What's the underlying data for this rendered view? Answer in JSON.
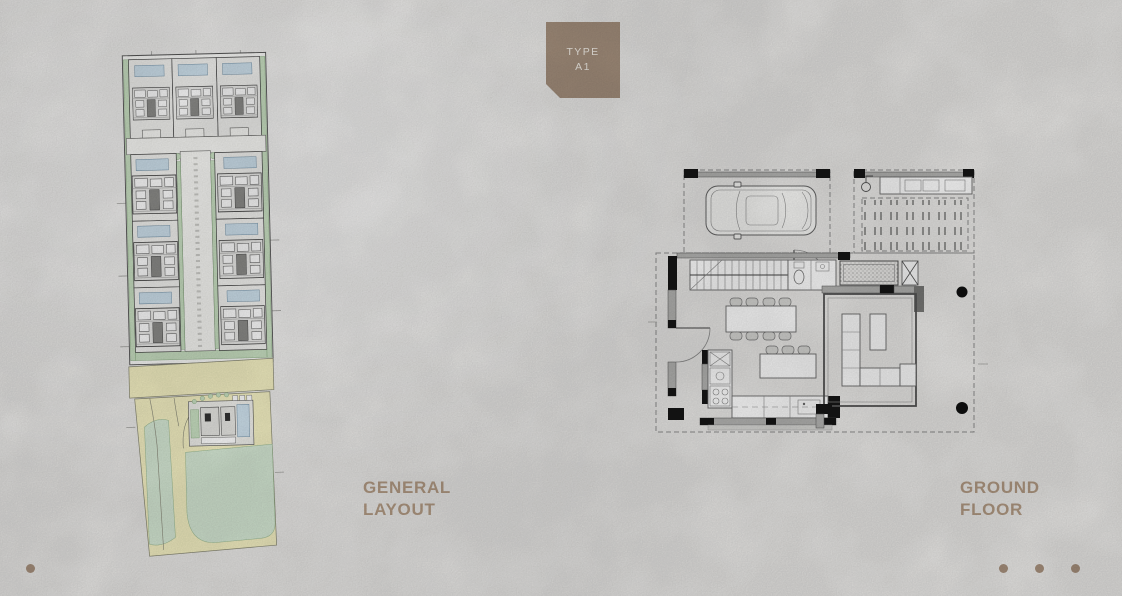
{
  "theme": {
    "bg": "#edecea",
    "accent": "#a6917e",
    "badge-text": "#f6f1ea",
    "label": "#b49c85",
    "dot": "#a8917d",
    "pool": "#cfe2ee",
    "green": "#cbe2c4",
    "green-stroke": "#85a97c",
    "road": "#f8f4c6",
    "lawn": "#d9ecd8",
    "wall-gray": "#b5b5b3",
    "wall-black": "#161616",
    "dash": "#8f8f8f"
  },
  "badge": {
    "line1": "TYPE",
    "line2": "A1"
  },
  "panels": {
    "general_layout": {
      "label_line1": "GENERAL",
      "label_line2": "LAYOUT"
    },
    "ground_floor": {
      "label_line1": "GROUND",
      "label_line2": "FLOOR"
    }
  },
  "pagination": {
    "left_count": 2,
    "right_count": 3
  },
  "drawings": {
    "site_plan": {
      "kind": "architectural-site-master-plan",
      "features": [
        "three-villa-row-top",
        "three-villa-column-left",
        "three-villa-column-right",
        "central-access-road",
        "swimming-pools",
        "perimeter-landscaping",
        "main-road-band",
        "corner-villa-lot",
        "lawn-areas"
      ]
    },
    "floor_plan": {
      "kind": "villa-ground-floor-plan",
      "features": [
        "carport-with-car",
        "pergola-terrace",
        "outdoor-kitchen-counter",
        "staircase",
        "wc",
        "planter",
        "dining-table-8-seats",
        "dining-table-3-seats",
        "kitchen-counters",
        "l-shaped-sofa",
        "coffee-table",
        "structural-columns",
        "entry-doors"
      ]
    }
  }
}
